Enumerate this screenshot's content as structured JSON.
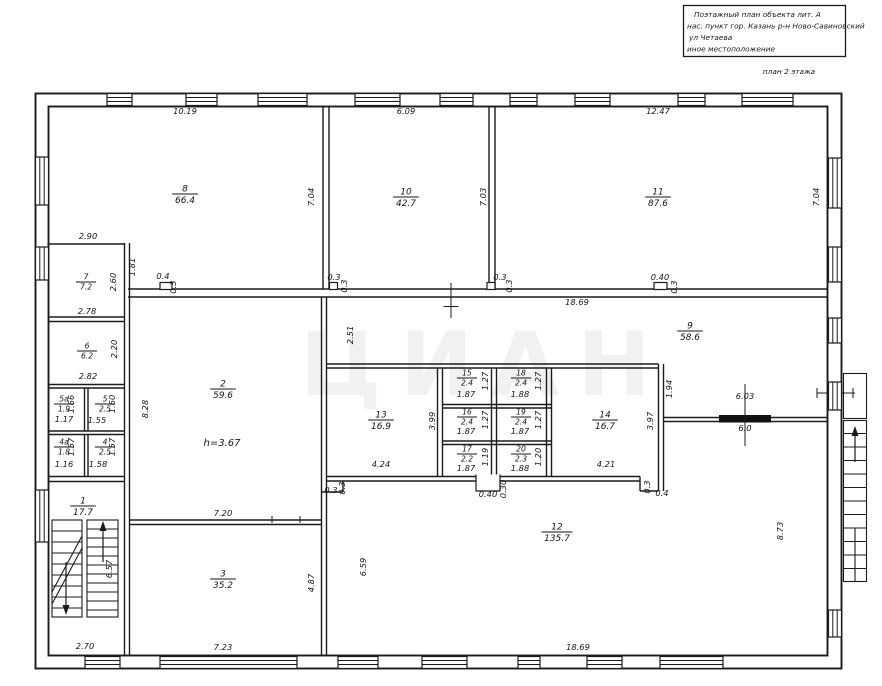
{
  "title_block": {
    "line1": "Поэтажный план объекта лит. А",
    "line2": "нас. пункт гор. Казань р-н  Ново-Савиновский",
    "line3": "ул Четаева",
    "line4": "иное местоположение",
    "caption": "план 2  этажа"
  },
  "watermark": "ЦИАН",
  "ceiling_height": "h=3.67",
  "rooms": [
    {
      "n": "1",
      "a": "17.7",
      "x": 83,
      "y": 506
    },
    {
      "n": "2",
      "a": "59.6",
      "x": 223,
      "y": 389
    },
    {
      "n": "3",
      "a": "35.2",
      "x": 223,
      "y": 579
    },
    {
      "n": "4",
      "a": "2.5",
      "x": 105,
      "y": 447
    },
    {
      "n": "4а",
      "a": "1.8",
      "x": 64,
      "y": 447
    },
    {
      "n": "5",
      "a": "2.5",
      "x": 105,
      "y": 404
    },
    {
      "n": "5а",
      "a": "1.9",
      "x": 64,
      "y": 404
    },
    {
      "n": "6",
      "a": "6.2",
      "x": 87,
      "y": 351
    },
    {
      "n": "7",
      "a": "7.2",
      "x": 86,
      "y": 282
    },
    {
      "n": "8",
      "a": "66.4",
      "x": 185,
      "y": 194
    },
    {
      "n": "9",
      "a": "58.6",
      "x": 690,
      "y": 331
    },
    {
      "n": "10",
      "a": "42.7",
      "x": 406,
      "y": 197
    },
    {
      "n": "11",
      "a": "87.6",
      "x": 658,
      "y": 197
    },
    {
      "n": "12",
      "a": "135.7",
      "x": 557,
      "y": 532
    },
    {
      "n": "13",
      "a": "16.9",
      "x": 381,
      "y": 420
    },
    {
      "n": "14",
      "a": "16.7",
      "x": 605,
      "y": 420
    },
    {
      "n": "15",
      "a": "2.4",
      "x": 467,
      "y": 378
    },
    {
      "n": "16",
      "a": "2.4",
      "x": 467,
      "y": 417
    },
    {
      "n": "17",
      "a": "2.2",
      "x": 467,
      "y": 454
    },
    {
      "n": "18",
      "a": "2.4",
      "x": 521,
      "y": 378
    },
    {
      "n": "19",
      "a": "2.4",
      "x": 521,
      "y": 417
    },
    {
      "n": "20",
      "a": "2.3",
      "x": 521,
      "y": 454
    }
  ],
  "dimensions": [
    {
      "t": "10.19",
      "x": 185,
      "y": 114
    },
    {
      "t": "6.09",
      "x": 406,
      "y": 114
    },
    {
      "t": "12.47",
      "x": 658,
      "y": 114
    },
    {
      "t": "7.04",
      "x": 314,
      "y": 197,
      "r": 1
    },
    {
      "t": "7.03",
      "x": 486,
      "y": 197,
      "r": 1
    },
    {
      "t": "7.04",
      "x": 819,
      "y": 197,
      "r": 1
    },
    {
      "t": "2.90",
      "x": 88,
      "y": 239
    },
    {
      "t": "1.81",
      "x": 135,
      "y": 267,
      "r": 1
    },
    {
      "t": "2.60",
      "x": 116,
      "y": 282,
      "r": 1
    },
    {
      "t": "0.4",
      "x": 163,
      "y": 279
    },
    {
      "t": "0.3",
      "x": 176,
      "y": 287,
      "r": 1
    },
    {
      "t": "2.78",
      "x": 87,
      "y": 314
    },
    {
      "t": "2.20",
      "x": 117,
      "y": 349,
      "r": 1
    },
    {
      "t": "2.82",
      "x": 88,
      "y": 379
    },
    {
      "t": "1.66",
      "x": 74,
      "y": 404,
      "r": 1
    },
    {
      "t": "1.17",
      "x": 64,
      "y": 422
    },
    {
      "t": "1.60",
      "x": 115,
      "y": 404,
      "r": 1
    },
    {
      "t": "1.55",
      "x": 97,
      "y": 423
    },
    {
      "t": "1.57",
      "x": 74,
      "y": 447,
      "r": 1
    },
    {
      "t": "1.16",
      "x": 64,
      "y": 467
    },
    {
      "t": "1.57",
      "x": 115,
      "y": 447,
      "r": 1
    },
    {
      "t": "1.58",
      "x": 98,
      "y": 467
    },
    {
      "t": "8.28",
      "x": 148,
      "y": 409,
      "r": 1
    },
    {
      "t": "0.3",
      "x": 334,
      "y": 280
    },
    {
      "t": "0.3",
      "x": 347,
      "y": 286,
      "r": 1
    },
    {
      "t": "0.3",
      "x": 500,
      "y": 280
    },
    {
      "t": "0.3",
      "x": 512,
      "y": 286,
      "r": 1
    },
    {
      "t": "18.69",
      "x": 577,
      "y": 305
    },
    {
      "t": "0.40",
      "x": 660,
      "y": 280
    },
    {
      "t": "0.3",
      "x": 677,
      "y": 287,
      "r": 1
    },
    {
      "t": "2.51",
      "x": 353,
      "y": 335,
      "r": 1
    },
    {
      "t": "3.99",
      "x": 435,
      "y": 421,
      "r": 1
    },
    {
      "t": "1.87",
      "x": 466,
      "y": 397
    },
    {
      "t": "1.27",
      "x": 488,
      "y": 381,
      "r": 1
    },
    {
      "t": "1.88",
      "x": 520,
      "y": 397
    },
    {
      "t": "1.27",
      "x": 541,
      "y": 381,
      "r": 1
    },
    {
      "t": "1.87",
      "x": 466,
      "y": 434
    },
    {
      "t": "1.27",
      "x": 488,
      "y": 420,
      "r": 1
    },
    {
      "t": "1.87",
      "x": 520,
      "y": 434
    },
    {
      "t": "1.27",
      "x": 541,
      "y": 420,
      "r": 1
    },
    {
      "t": "1.87",
      "x": 466,
      "y": 471
    },
    {
      "t": "1.19",
      "x": 488,
      "y": 457,
      "r": 1
    },
    {
      "t": "1.88",
      "x": 520,
      "y": 471
    },
    {
      "t": "1.20",
      "x": 541,
      "y": 457,
      "r": 1
    },
    {
      "t": "4.24",
      "x": 381,
      "y": 467
    },
    {
      "t": "4.21",
      "x": 606,
      "y": 467
    },
    {
      "t": "3.97",
      "x": 653,
      "y": 421,
      "r": 1
    },
    {
      "t": "1.94",
      "x": 672,
      "y": 389,
      "r": 1
    },
    {
      "t": "6.03",
      "x": 745,
      "y": 399
    },
    {
      "t": "6.0",
      "x": 745,
      "y": 431
    },
    {
      "t": "0.3",
      "x": 331,
      "y": 493
    },
    {
      "t": "0.3",
      "x": 345,
      "y": 488,
      "r": 1
    },
    {
      "t": "0.40",
      "x": 488,
      "y": 497
    },
    {
      "t": "0.30",
      "x": 506,
      "y": 489,
      "r": 1
    },
    {
      "t": "0.3",
      "x": 650,
      "y": 487,
      "r": 1
    },
    {
      "t": "0.4",
      "x": 662,
      "y": 496
    },
    {
      "t": "7.20",
      "x": 223,
      "y": 516
    },
    {
      "t": "6.57",
      "x": 112,
      "y": 569,
      "r": 1
    },
    {
      "t": "2.70",
      "x": 85,
      "y": 649
    },
    {
      "t": "7.23",
      "x": 223,
      "y": 650
    },
    {
      "t": "4.87",
      "x": 314,
      "y": 583,
      "r": 1
    },
    {
      "t": "6.59",
      "x": 366,
      "y": 567,
      "r": 1
    },
    {
      "t": "18.69",
      "x": 578,
      "y": 650
    },
    {
      "t": "8.73",
      "x": 783,
      "y": 531,
      "r": 1
    }
  ]
}
